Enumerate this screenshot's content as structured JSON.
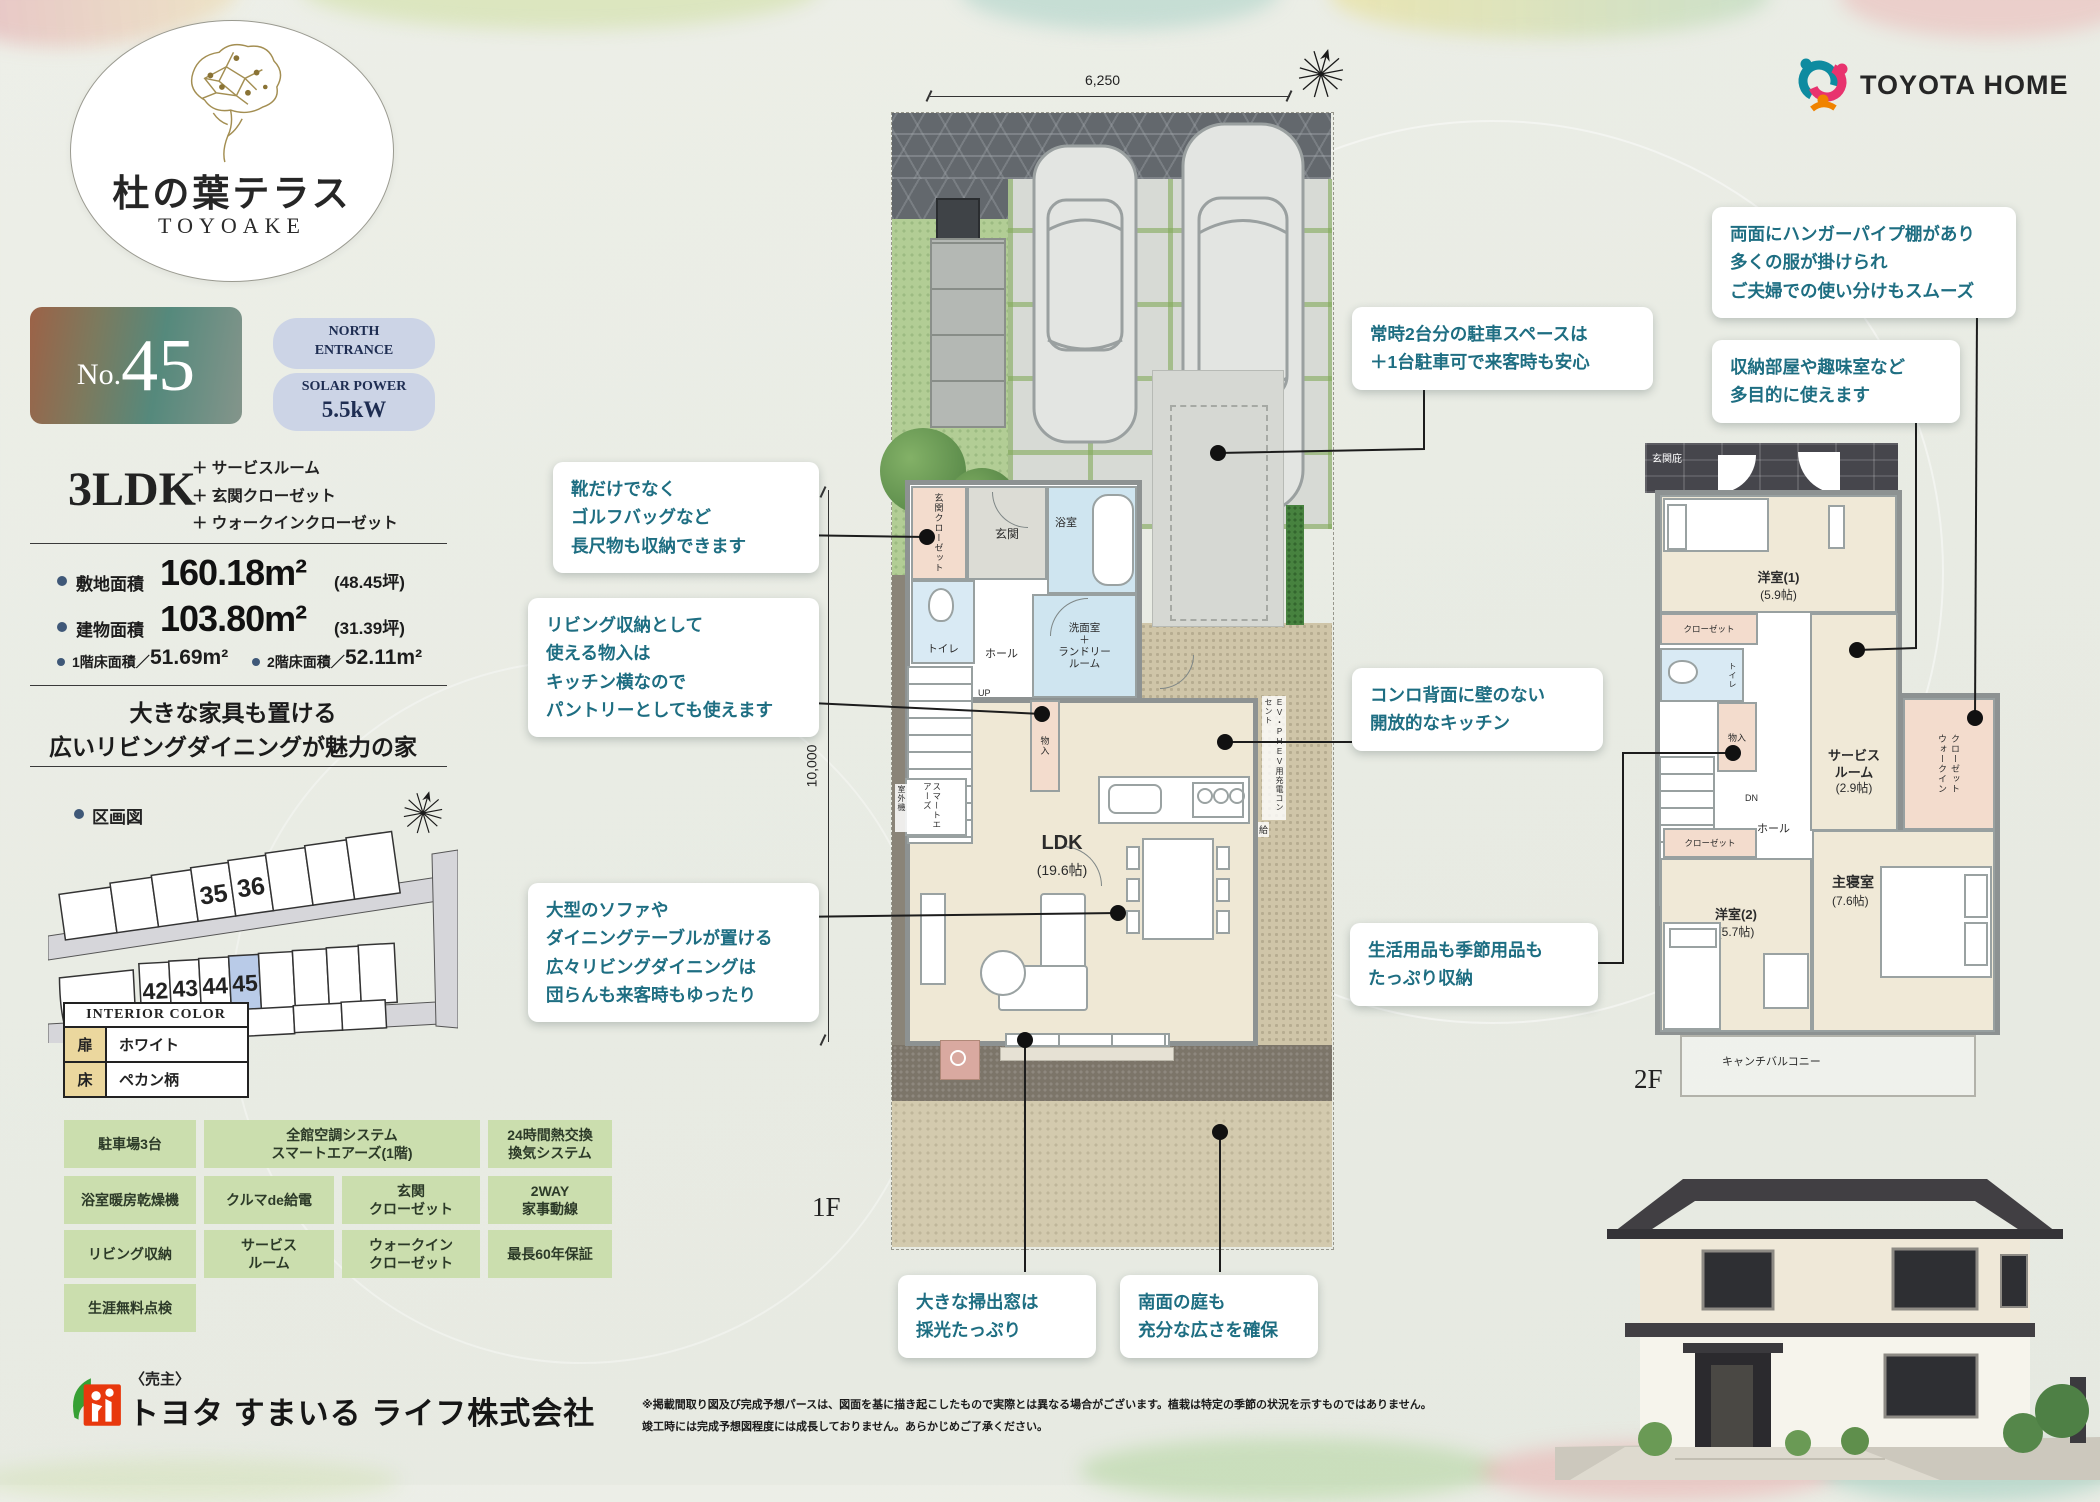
{
  "colors": {
    "teal_text": "#1e6e82",
    "pill_bg": "#ccd4e6",
    "feature_bg": "#cbdeae",
    "lot_highlight": "#b9cbe8",
    "badge_left": "#9c6247",
    "badge_right": "#6f9383"
  },
  "brand": {
    "title": "杜の葉テラス",
    "subtitle": "TOYOAKE",
    "partner": "TOYOTA HOME"
  },
  "unit": {
    "no_label": "No.",
    "no_value": "45"
  },
  "pills": [
    {
      "l1": "NORTH",
      "l2": "ENTRANCE"
    },
    {
      "l1": "SOLAR POWER",
      "l2": "5.5kW"
    }
  ],
  "plan_type": "3LDK",
  "plan_plus": [
    "＋ サービスルーム",
    "＋ 玄関クローゼット",
    "＋ ウォークインクローゼット"
  ],
  "areas": {
    "site_label": "敷地面積",
    "site_value": "160.18m²",
    "site_tsubo": "(48.45坪)",
    "bld_label": "建物面積",
    "bld_value": "103.80m²",
    "bld_tsubo": "(31.39坪)",
    "f1_label": "1階床面積／",
    "f1_value": "51.69m²",
    "f2_label": "2階床面積／",
    "f2_value": "52.11m²"
  },
  "catch": {
    "line1": "大きな家具も置ける",
    "line2": "広いリビングダイニングが魅力の家"
  },
  "site_map": {
    "label": "区画図",
    "lots": [
      "35",
      "36",
      "42",
      "43",
      "44",
      "45"
    ]
  },
  "interior": {
    "title": "INTERIOR COLOR",
    "rows": [
      {
        "k": "扉",
        "v": "ホワイト"
      },
      {
        "k": "床",
        "v": "ペカン柄"
      }
    ]
  },
  "features": {
    "cells": [
      {
        "lines": [
          "駐車場3台"
        ]
      },
      {
        "lines": [
          "全館空調システム",
          "スマートエアーズ(1階)"
        ]
      },
      {
        "lines": [
          "24時間熱交換",
          "換気システム"
        ]
      },
      {
        "lines": [
          "浴室暖房乾燥機"
        ]
      },
      {
        "lines": [
          "クルマde給電"
        ]
      },
      {
        "lines": [
          "玄関",
          "クローゼット"
        ]
      },
      {
        "lines": [
          "2WAY",
          "家事動線"
        ]
      },
      {
        "lines": [
          "リビング収納"
        ]
      },
      {
        "lines": [
          "サービス",
          "ルーム"
        ]
      },
      {
        "lines": [
          "ウォークイン",
          "クローゼット"
        ]
      },
      {
        "lines": [
          "最長60年保証"
        ]
      },
      {
        "lines": [
          "生涯無料点検"
        ]
      }
    ]
  },
  "callouts": [
    {
      "lines": [
        "靴だけでなく",
        "ゴルフバッグなど",
        "長尺物も収納できます"
      ]
    },
    {
      "lines": [
        "リビング収納として",
        "使える物入は",
        "キッチン横なので",
        "パントリーとしても使えます"
      ]
    },
    {
      "lines": [
        "大型のソファや",
        "ダイニングテーブルが置ける",
        "広々リビングダイニングは",
        "団らんも来客時もゆったり"
      ]
    },
    {
      "lines": [
        "常時2台分の駐車スペースは",
        "＋1台駐車可で来客時も安心"
      ]
    },
    {
      "lines": [
        "コンロ背面に壁のない",
        "開放的なキッチン"
      ]
    },
    {
      "lines": [
        "両面にハンガーパイプ棚があり",
        "多くの服が掛けられ",
        "ご夫婦での使い分けもスムーズ"
      ]
    },
    {
      "lines": [
        "収納部屋や趣味室など",
        "多目的に使えます"
      ]
    },
    {
      "lines": [
        "生活用品も季節用品も",
        "たっぷり収納"
      ]
    },
    {
      "lines": [
        "大きな掃出窓は",
        "採光たっぷり"
      ]
    },
    {
      "lines": [
        "南面の庭も",
        "充分な広さを確保"
      ]
    }
  ],
  "plan1f": {
    "floor": "1F",
    "dim_width": "6,250",
    "dim_height": "10,000",
    "labels": {
      "genkan_cl": "玄関クローゼット",
      "genkan": "玄関",
      "bath": "浴室",
      "wash": [
        "洗面室",
        "＋",
        "ランドリー",
        "ルーム"
      ],
      "toilet": "トイレ",
      "hall": "ホール",
      "up": "UP",
      "mono": "物入",
      "ldk": "LDK",
      "ldk_size": "(19.6帖)",
      "smart": "スマートエアーズ",
      "outdoor": "室外機",
      "ev": "EV・PHEV用充電コンセント",
      "kyu": "給"
    }
  },
  "plan2f": {
    "floor": "2F",
    "labels": {
      "hisashi": "玄関庇",
      "yo1": "洋室(1)",
      "yo1s": "(5.9帖)",
      "closet1": "クローゼット",
      "toilet": "トイレ",
      "mono": "物入",
      "dn": "DN",
      "hall": "ホール",
      "service1": "サービス",
      "service2": "ルーム",
      "services": "(2.9帖)",
      "wic1": "ウォークイン",
      "wic2": "クローゼット",
      "closet2": "クローゼット",
      "yo2": "洋室(2)",
      "yo2s": "(5.7帖)",
      "main": "主寝室",
      "mains": "(7.6帖)",
      "balcony": "キャンチバルコニー"
    }
  },
  "seller": {
    "label": "〈売主〉",
    "company": "トヨタ すまいる ライフ株式会社"
  },
  "disclaimer": {
    "line1": "※掲載間取り図及び完成予想パースは、図面を基に描き起こしたもので実際とは異なる場合がございます。植栽は特定の季節の状況を示すものではありません。",
    "line2": "竣工時には完成予想図程度には成長しておりません。あらかじめご了承ください。"
  }
}
